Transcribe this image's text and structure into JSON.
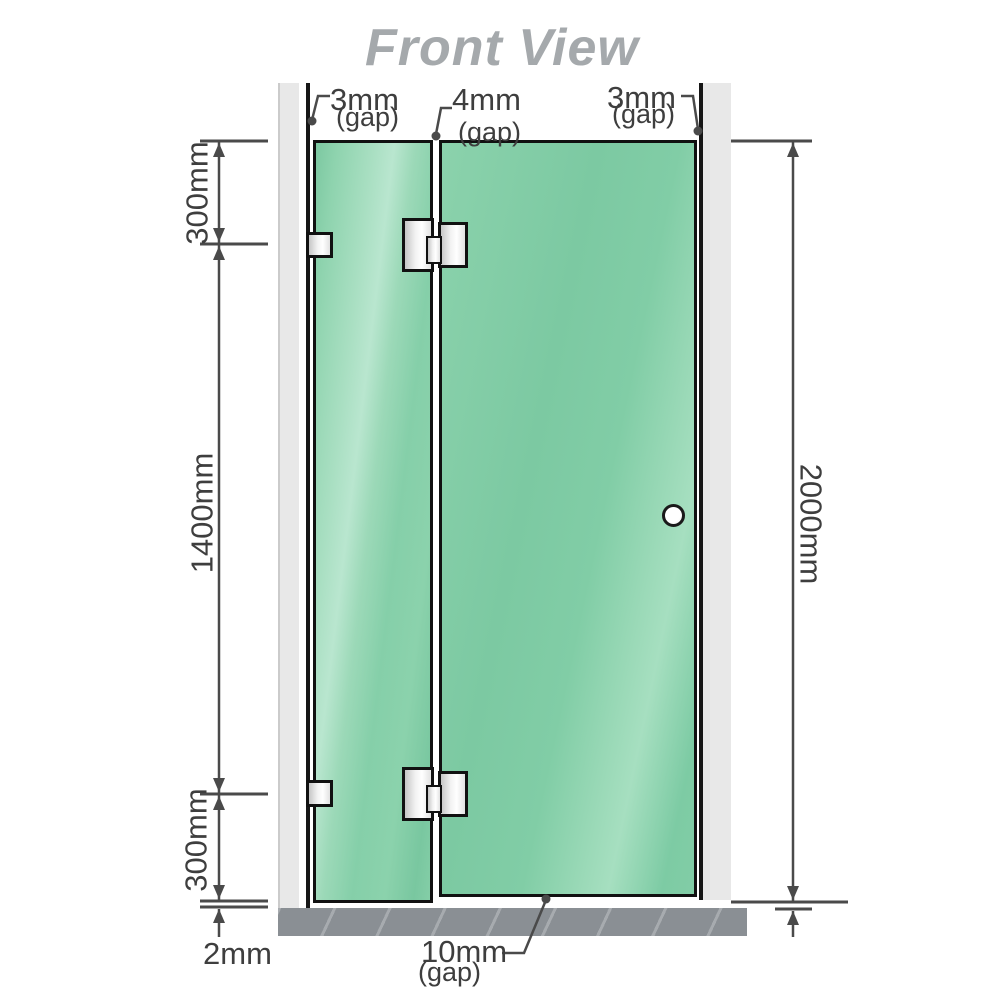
{
  "title": "Front View",
  "annotations": {
    "top_left_gap": {
      "value": "3mm",
      "note": "(gap)"
    },
    "top_middle_gap": {
      "value": "4mm",
      "note": "(gap)"
    },
    "top_right_gap": {
      "value": "3mm",
      "note": "(gap)"
    },
    "left_upper": "300mm",
    "left_middle": "1400mm",
    "left_lower": "300mm",
    "right_total": "2000mm",
    "bottom_floor_gap": "2mm",
    "bottom_door_gap": {
      "value": "10mm",
      "note": "(gap)"
    }
  },
  "colors": {
    "glass_green": "#7fcba4",
    "glass_highlight": "#b5e4cc",
    "wall_channel_gray": "#e8e8e8",
    "floor_gray": "#8a8f94",
    "outline_black": "#111111",
    "dimension_gray": "#4a4a4a",
    "title_gray": "#a5a9ac",
    "label_gray": "#3e3e3e",
    "hinge_metal": "#ececec"
  }
}
